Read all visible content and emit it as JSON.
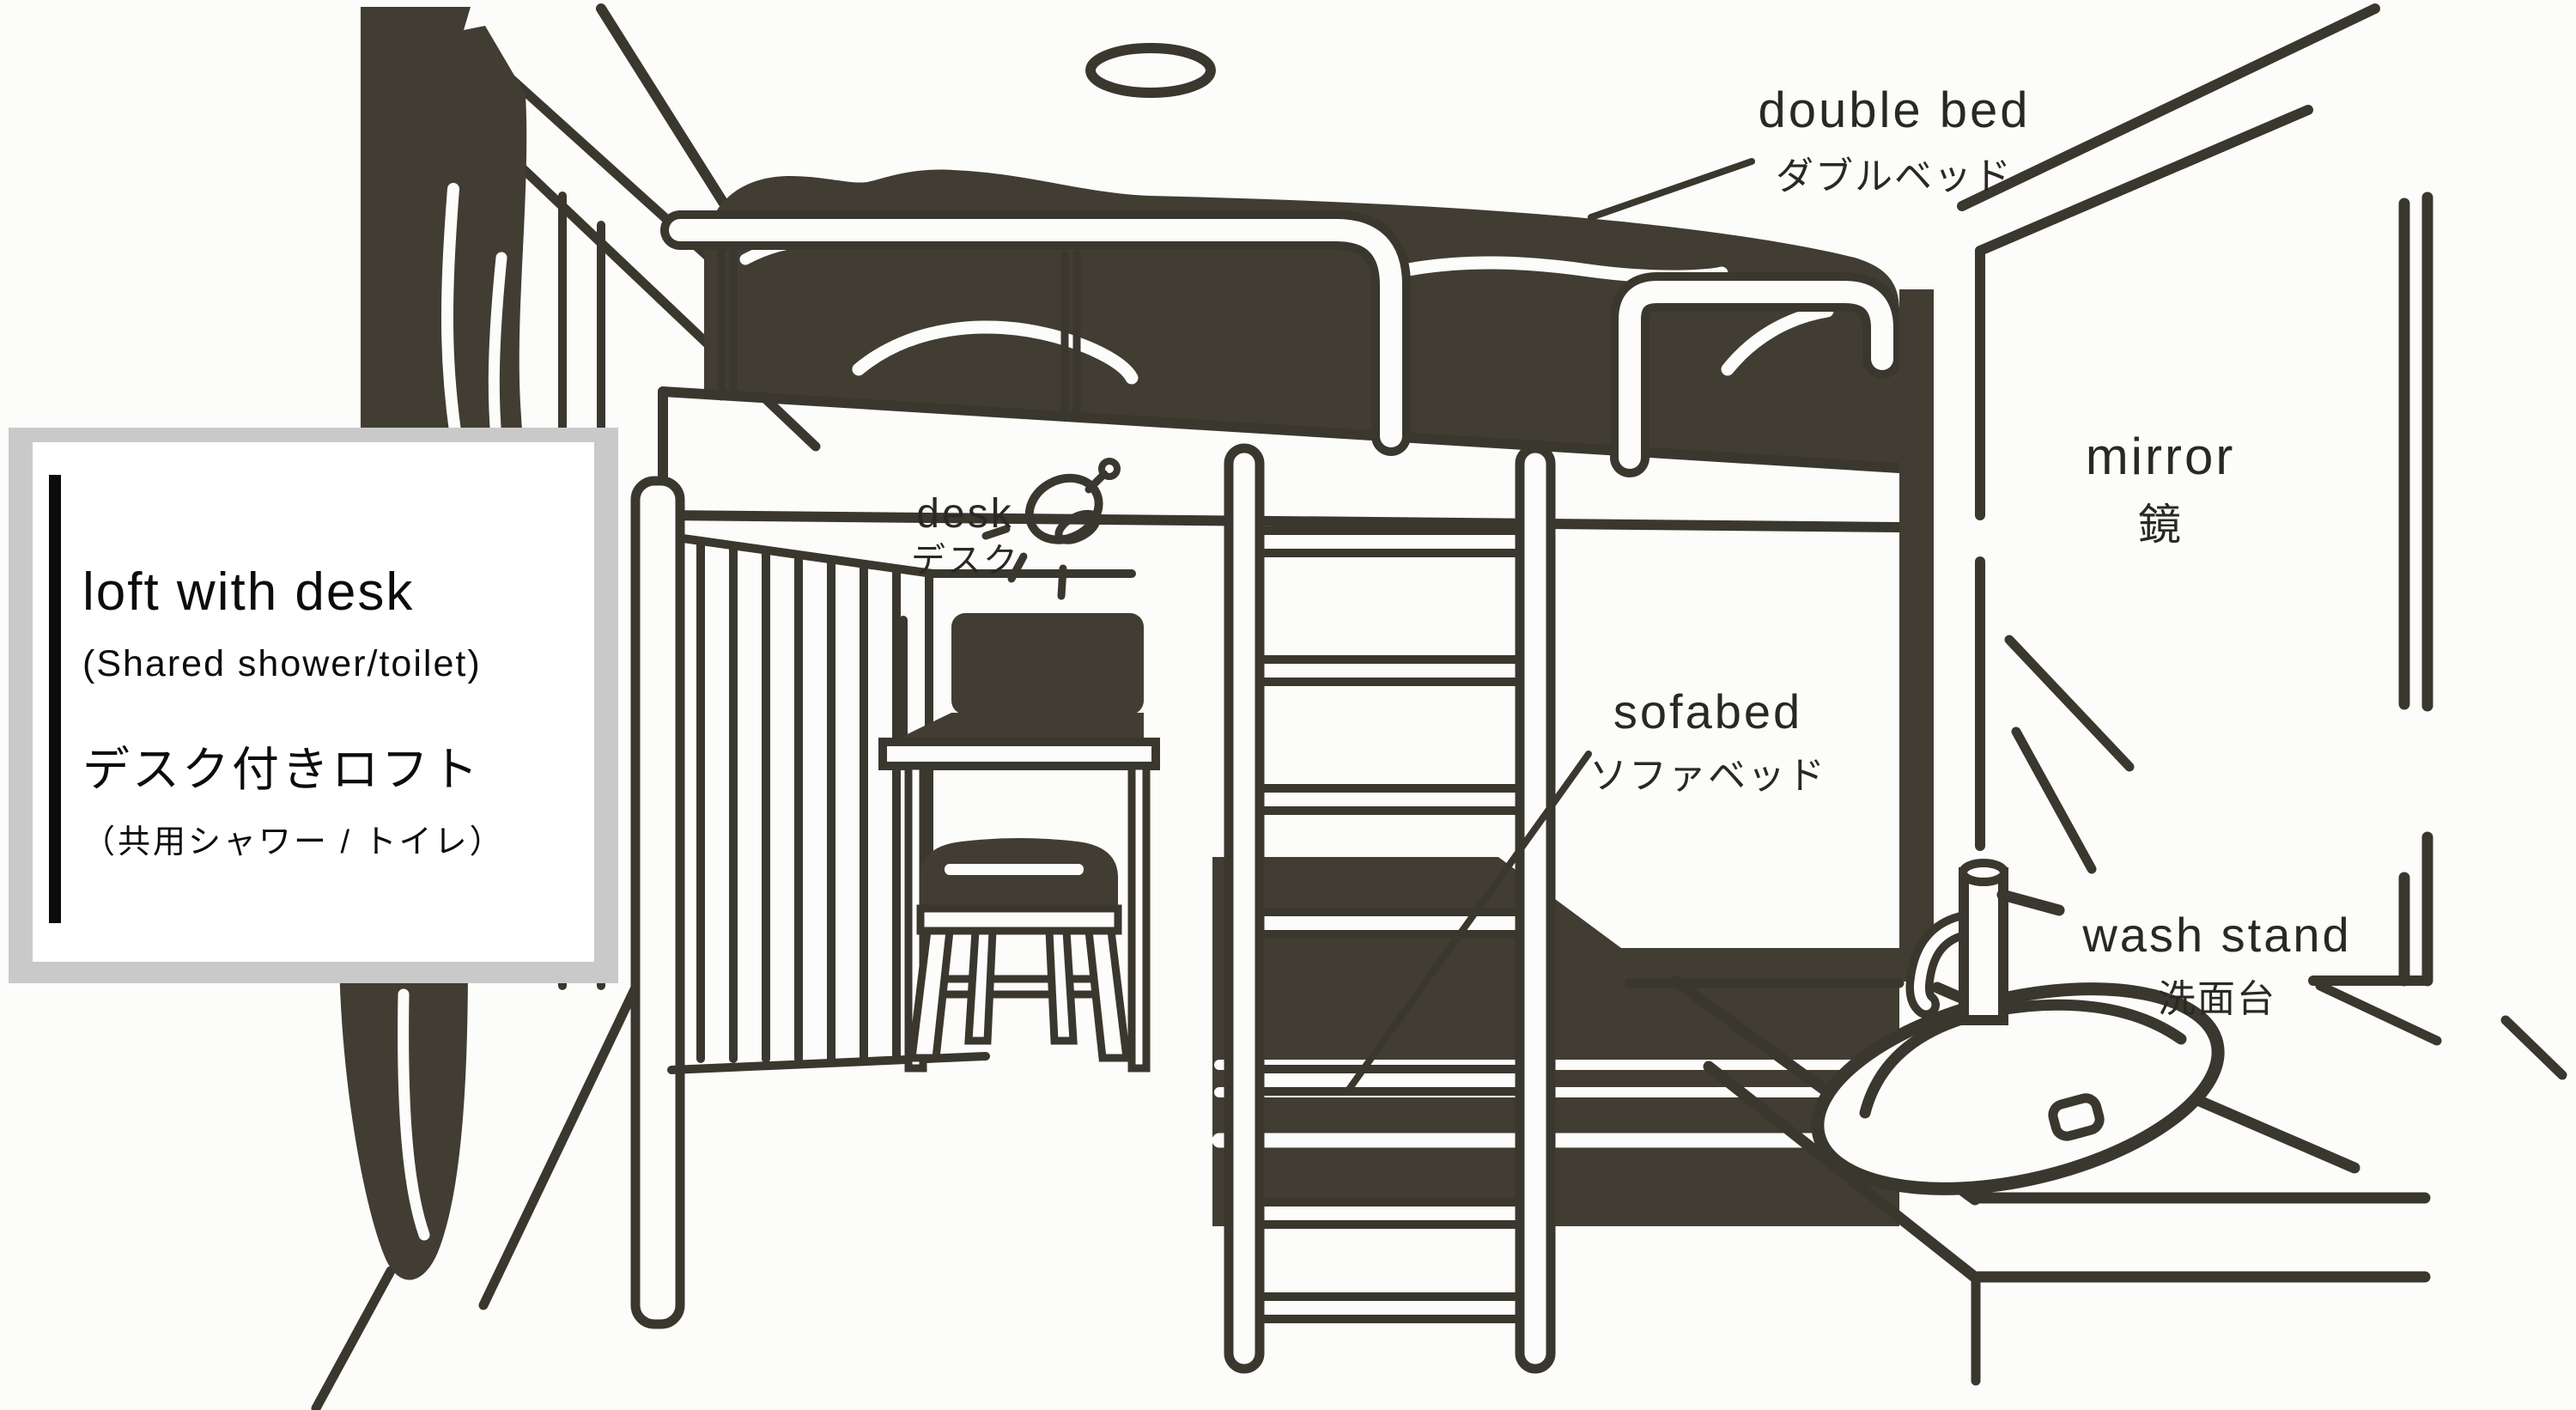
{
  "page": {
    "background": "#fcfcfa",
    "ink_color": "#413d33",
    "line_color": "#3a372e",
    "text_color": "#2a2823"
  },
  "title_card": {
    "title_en": "loft with desk",
    "subtitle_en": "(Shared shower/toilet)",
    "title_ja": "デスク付きロフト",
    "subtitle_ja": "（共用シャワー / トイレ）",
    "card_bg": "#ffffff",
    "card_shadow": "#c9c9c9",
    "accent_bar_color": "#0c0c0c"
  },
  "labels": {
    "double_bed": {
      "en": "double bed",
      "ja": "ダブルベッド"
    },
    "mirror": {
      "en": "mirror",
      "ja": "鏡"
    },
    "desk": {
      "en": "desk",
      "ja": "デスク"
    },
    "sofabed": {
      "en": "sofabed",
      "ja": "ソファベッド"
    },
    "wash_stand": {
      "en": "wash stand",
      "ja": "洗面台"
    }
  },
  "icons": {
    "ceiling_light": "ceiling-light-icon",
    "desk_lamp": "desk-lamp-icon"
  },
  "furniture": [
    "double bed (loft)",
    "desk",
    "stool",
    "ladder",
    "sofabed",
    "wash stand",
    "mirror",
    "curtain"
  ]
}
